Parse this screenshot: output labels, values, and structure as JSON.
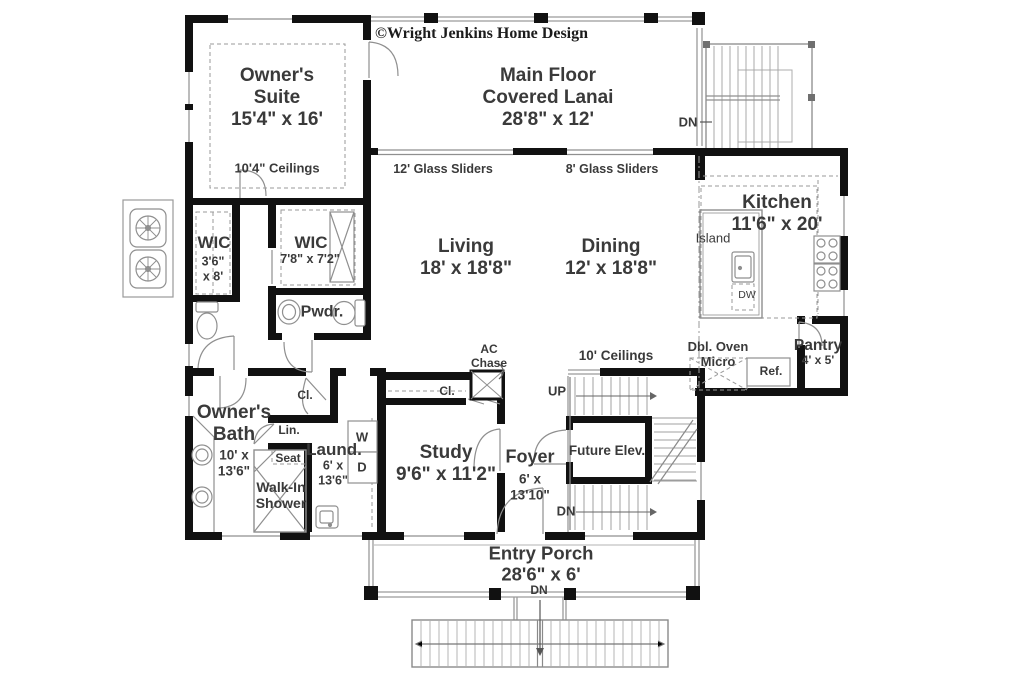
{
  "meta": {
    "copyright": "©Wright Jenkins Home Design"
  },
  "colors": {
    "wall": "#111111",
    "thin_line": "#8f8f8f",
    "text": "#3a3a3a"
  },
  "rooms": {
    "owners_suite": {
      "label": "Owner's\nSuite\n15'4\" x 16'",
      "ceiling": "10'4\" Ceilings"
    },
    "lanai": {
      "label": "Main Floor\nCovered Lanai\n28'8\" x 12'"
    },
    "living": {
      "label": "Living\n18' x 18'8\""
    },
    "dining": {
      "label": "Dining\n12' x 18'8\""
    },
    "kitchen": {
      "label": "Kitchen\n11'6\" x 20'"
    },
    "pantry": {
      "name": "Pantry",
      "dims": "4' x 5'"
    },
    "wic_small": {
      "name": "WIC",
      "dims": "3'6\"\nx 8'"
    },
    "wic_large": {
      "name": "WIC",
      "dims": "7'8\" x 7'2\""
    },
    "powder": {
      "label": "Pwdr."
    },
    "owners_bath": {
      "name": "Owner's\nBath",
      "dims": "10' x\n13'6\""
    },
    "laundry": {
      "name": "Laund.",
      "dims": "6' x\n13'6\""
    },
    "study": {
      "label": "Study\n9'6\" x 11'2\""
    },
    "foyer": {
      "name": "Foyer",
      "dims": "6' x\n13'10\""
    },
    "entry_porch": {
      "label": "Entry Porch\n28'6\" x 6'"
    }
  },
  "features": {
    "future_elev": "Future Elev.",
    "walk_in_shower": "Walk-In\nShower",
    "seat": "Seat",
    "linen": "Lin.",
    "closet_bath": "Cl.",
    "closet_study": "Cl.",
    "ac_chase": "AC\nChase",
    "island": "Island",
    "dishwasher": "DW",
    "double_oven_micro": "Dbl. Oven\nMicro",
    "refrigerator": "Ref.",
    "washer": "W",
    "dryer": "D",
    "ceilings_10": "10' Ceilings",
    "sliders_12": "12' Glass Sliders",
    "sliders_8": "8' Glass Sliders",
    "up": "UP",
    "dn_exterior_stair": "DN",
    "dn_interior_stair": "DN",
    "dn_porch": "DN"
  }
}
